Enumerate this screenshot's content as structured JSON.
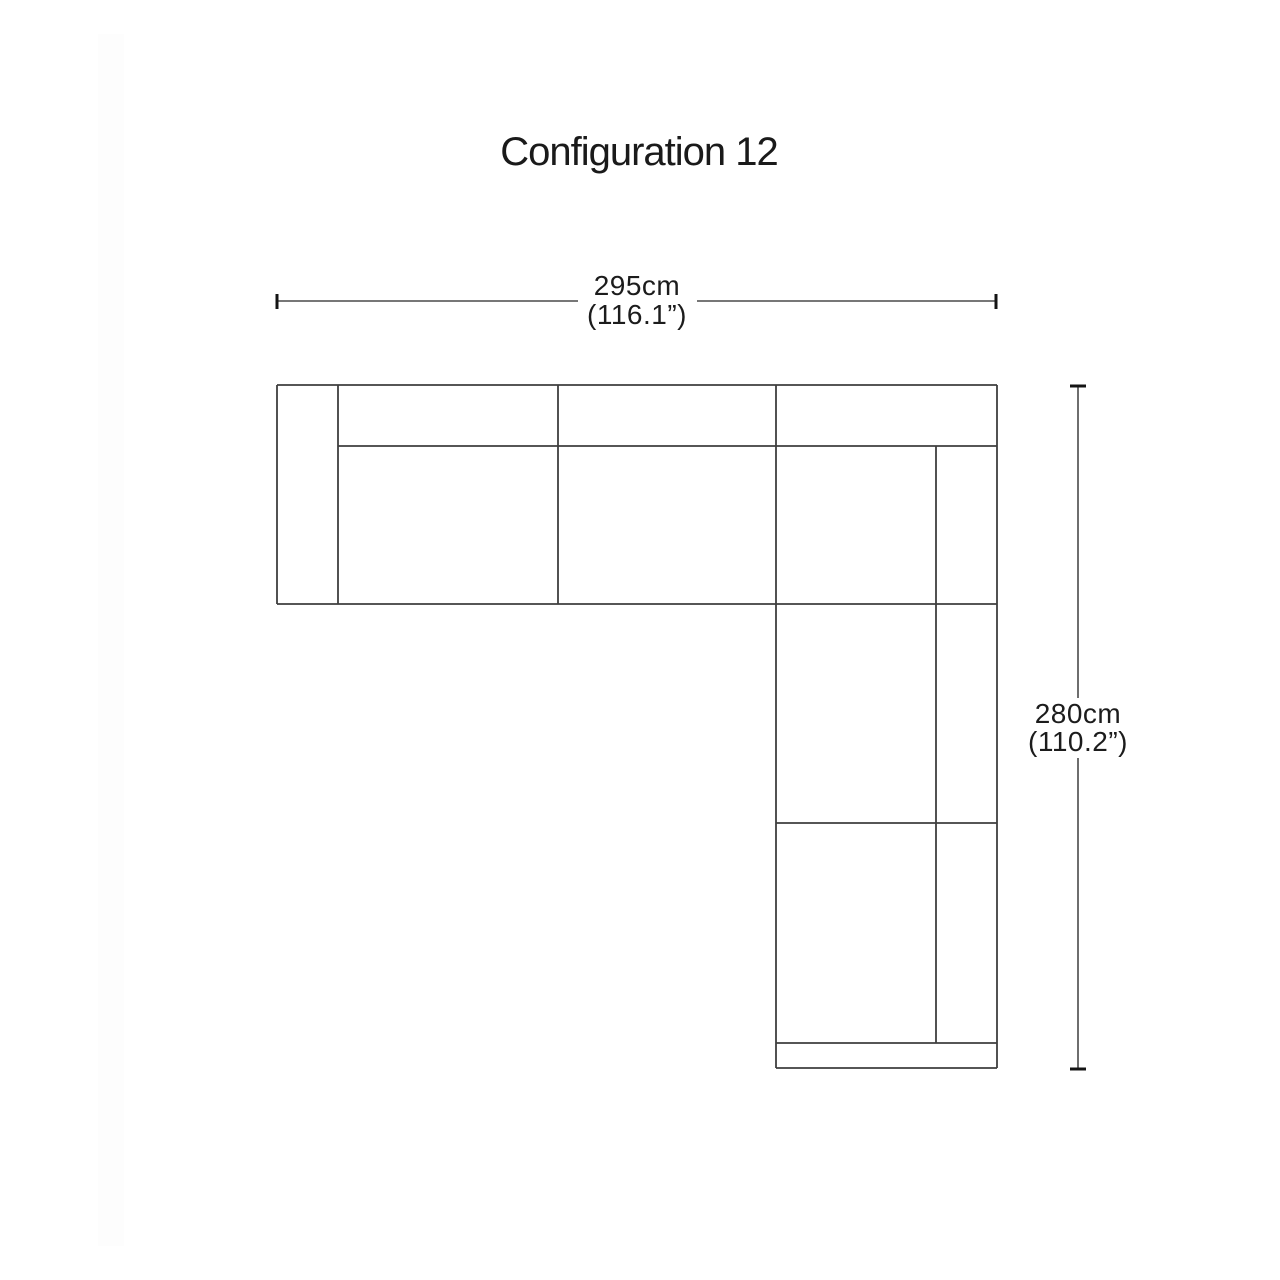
{
  "title": "Configuration 12",
  "dimensions": {
    "width": {
      "value_cm": "295cm",
      "value_in": "(116.1”)"
    },
    "height": {
      "value_cm": "280cm",
      "value_in": "(110.2”)"
    }
  },
  "colors": {
    "background": "#ffffff",
    "sofa_outline": "#3e3e3e",
    "dimension_line": "#4a4a4a",
    "dimension_tick": "#141414",
    "text": "#1c1c1c"
  }
}
